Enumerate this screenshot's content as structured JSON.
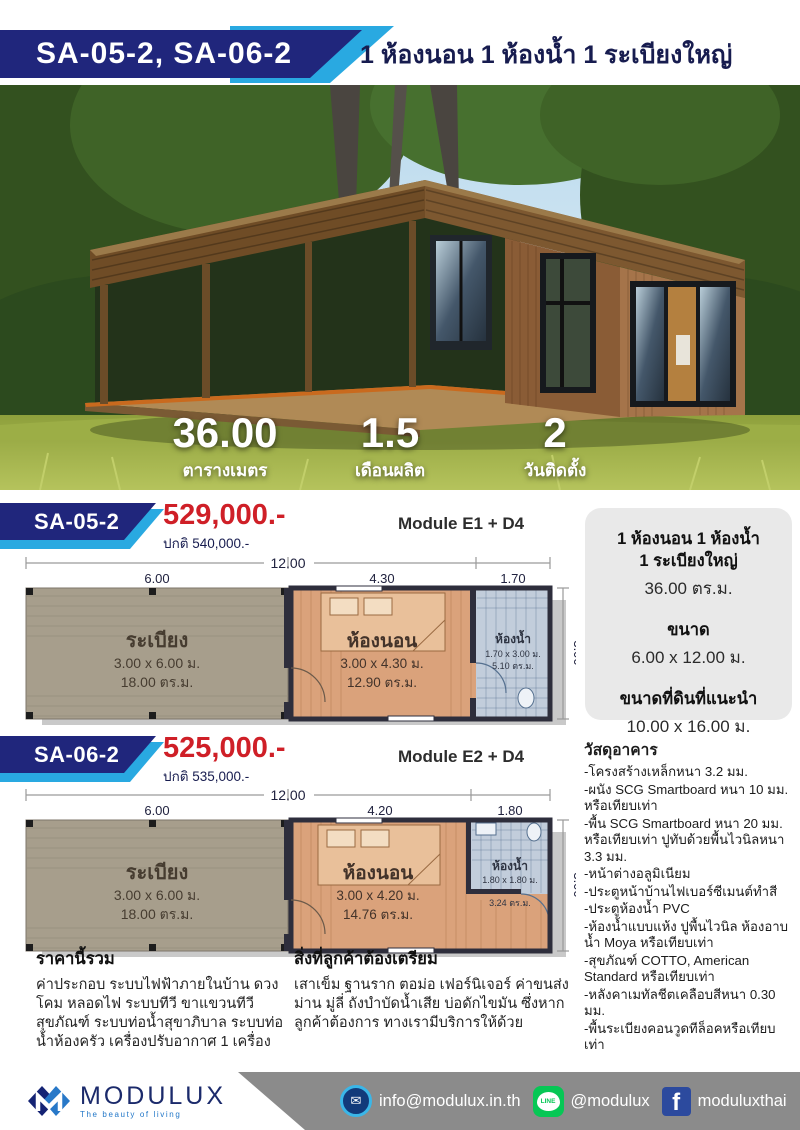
{
  "header": {
    "models": "SA-05-2, SA-06-2",
    "subtitle": "1 ห้องนอน 1 ห้องน้ำ 1 ระเบียงใหญ่"
  },
  "hero_stats": [
    {
      "value": "36.00",
      "label": "ตารางเมตร"
    },
    {
      "value": "1.5",
      "label": "เดือนผลิต"
    },
    {
      "value": "2",
      "label": "วันติดตั้ง"
    }
  ],
  "sections": [
    {
      "model": "SA-05-2",
      "price": "529,000.-",
      "normal_price": "ปกติ 540,000.-",
      "module": "Module E1 + D4",
      "plan": {
        "overall": "12.00",
        "dim1": "6.00",
        "dim2": "4.30",
        "dim3": "1.70",
        "depth": "3.00",
        "rooms": [
          {
            "name": "ระเบียง",
            "size": "3.00 x 6.00 ม.",
            "area": "18.00 ตร.ม."
          },
          {
            "name": "ห้องนอน",
            "size": "3.00 x 4.30 ม.",
            "area": "12.90 ตร.ม."
          },
          {
            "name": "ห้องน้ำ",
            "size": "1.70 x 3.00 ม.",
            "area": "5.10 ตร.ม."
          }
        ]
      }
    },
    {
      "model": "SA-06-2",
      "price": "525,000.-",
      "normal_price": "ปกติ 535,000.-",
      "module": "Module E2 + D4",
      "plan": {
        "overall": "12.00",
        "dim1": "6.00",
        "dim2": "4.20",
        "dim3": "1.80",
        "depth": "3.00",
        "rooms": [
          {
            "name": "ระเบียง",
            "size": "3.00 x 6.00 ม.",
            "area": "18.00 ตร.ม."
          },
          {
            "name": "ห้องนอน",
            "size": "3.00 x 4.20 ม.",
            "area": "14.76 ตร.ม."
          },
          {
            "name": "ห้องน้ำ",
            "size": "1.80 x 1.80 ม.",
            "area": "3.24 ตร.ม."
          }
        ]
      }
    }
  ],
  "info_panel": {
    "line1": "1 ห้องนอน 1 ห้องน้ำ",
    "line2": "1 ระเบียงใหญ่",
    "area": "36.00 ตร.ม.",
    "size_label": "ขนาด",
    "size": "6.00 x 12.00 ม.",
    "land_label": "ขนาดที่ดินที่แนะนำ",
    "land": "10.00 x 16.00 ม."
  },
  "materials": {
    "title": "วัสดุอาคาร",
    "items": [
      "-โครงสร้างเหล็กหนา 3.2 มม.",
      "-ผนัง SCG Smartboard หนา 10 มม. หรือเทียบเท่า",
      "-พื้น SCG Smartboard หนา 20 มม. หรือเทียบเท่า  ปูทับด้วยพื้นไวนิลหนา 3.3 มม.",
      "-หน้าต่างอลูมิเนียม",
      "-ประตูหน้าบ้านไฟเบอร์ซีเมนต์ทำสี",
      "-ประตูห้องน้ำ PVC",
      "-ห้องน้ำแบบแห้ง ปูพื้นไวนิล ห้องอาบน้ำ Moya หรือเทียบเท่า",
      "-สุขภัณฑ์ COTTO, American Standard หรือเทียบเท่า",
      "-หลังคาเมทัลชีตเคลือบสีหนา 0.30 มม.",
      "-พื้นระเบียงคอนวูดทีล็อคหรือเทียบเท่า"
    ]
  },
  "price_includes": {
    "title": "ราคานี้รวม",
    "body": "ค่าประกอบ ระบบไฟฟ้าภายในบ้าน ดวงโคม หลอดไฟ ระบบทีวี ขาแขวนทีวี สุขภัณฑ์ ระบบท่อน้ำสุขาภิบาล ระบบท่อน้ำห้องครัว เครื่องปรับอากาศ 1 เครื่อง"
  },
  "customer_prepares": {
    "title": "สิ่งที่ลูกค้าต้องเตรียม",
    "body": "เสาเข็ม ฐานราก ตอม่อ เฟอร์นิเจอร์ ค่าขนส่ง ม่าน มู่ลี่ ถังบำบัดน้ำเสีย บ่อดักไขมัน ซึ่งหากลูกค้าต้องการ ทางเรามีบริการให้ด้วย"
  },
  "footer": {
    "brand": "MODULUX",
    "tagline": "The beauty of living",
    "email": "info@modulux.in.th",
    "line": "@modulux",
    "facebook": "moduluxthai"
  },
  "colors": {
    "navy": "#20267c",
    "accent_blue": "#29a9e1",
    "price_red": "#cf1f27",
    "line_green": "#06c755",
    "facebook_blue": "#2c4a9e",
    "footer_gray": "#8b8b8b"
  }
}
